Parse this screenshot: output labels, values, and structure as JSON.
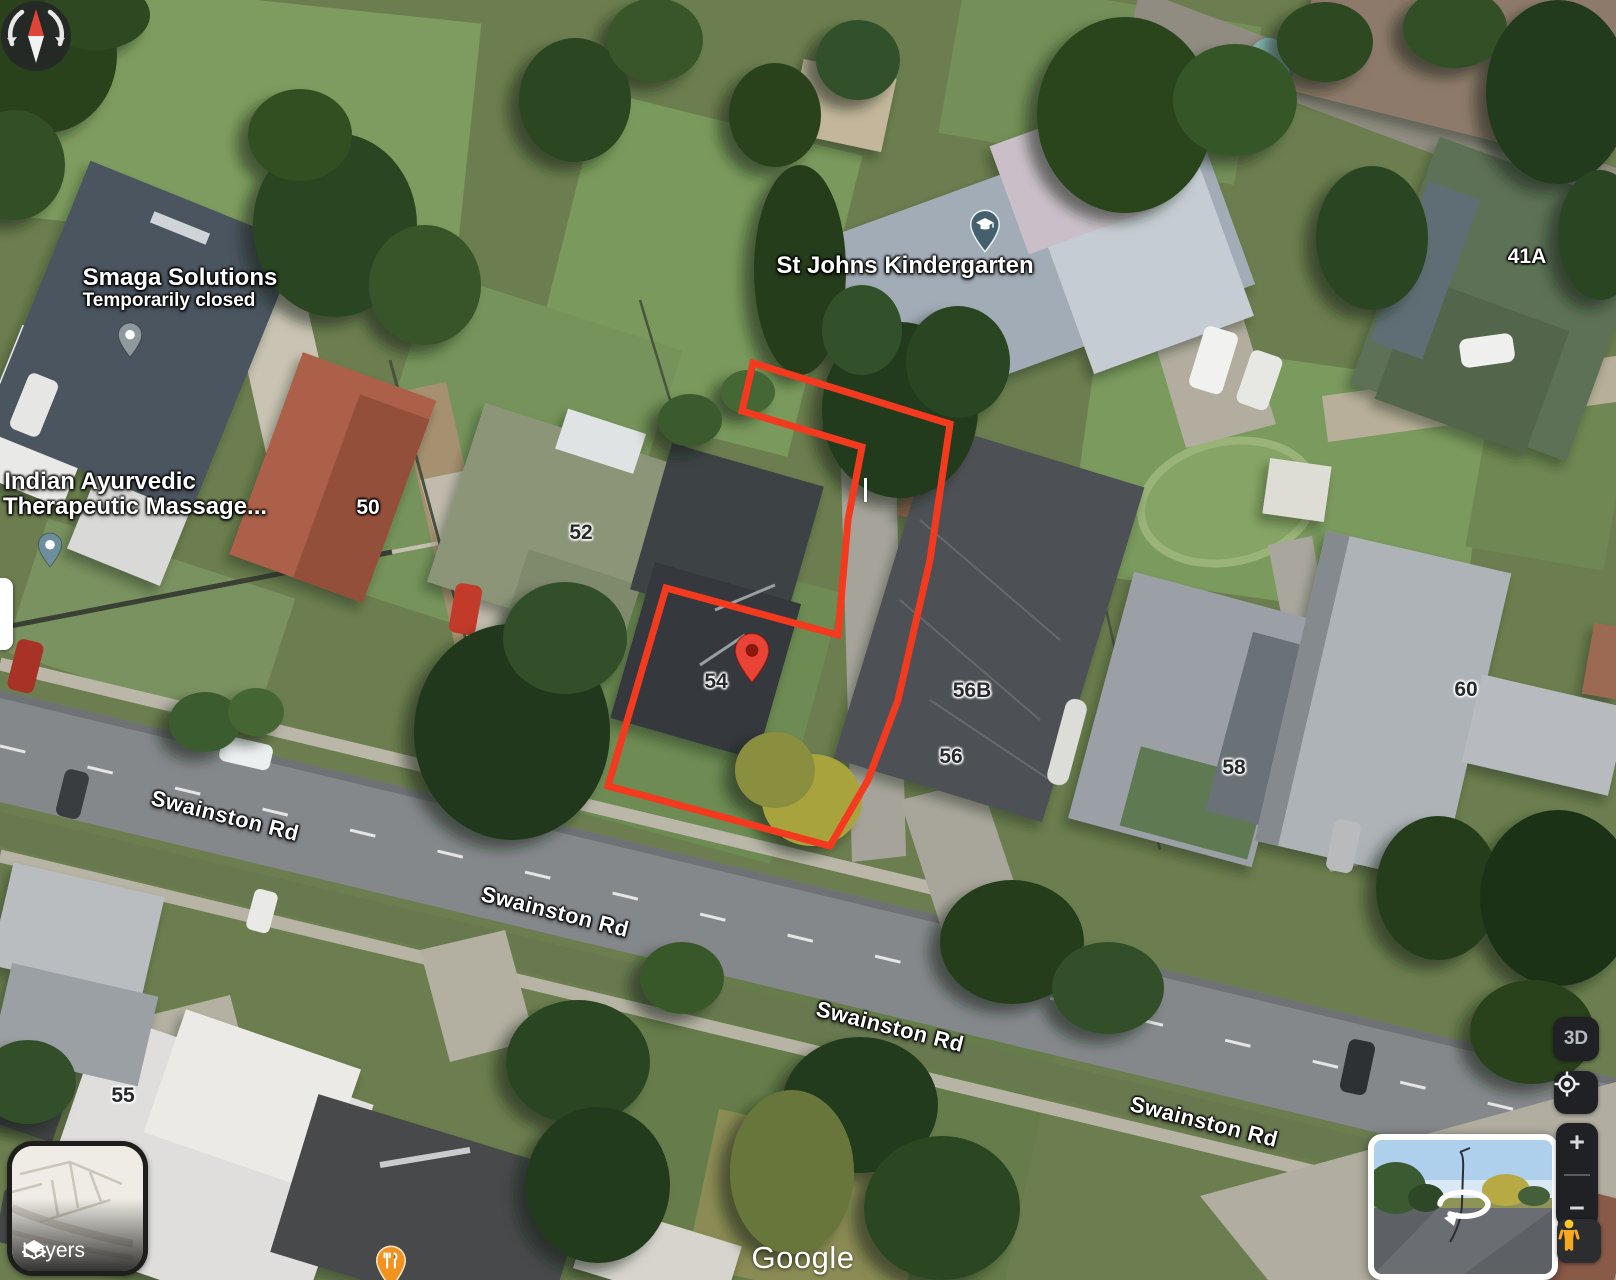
{
  "map": {
    "attribution": "Google",
    "street_label": "Swainston Rd",
    "street_label_partial": "S",
    "pois": {
      "smaga": {
        "name": "Smaga Solutions",
        "status": "Temporarily closed",
        "icon": "gray-place-pin"
      },
      "ayurvedic": {
        "name_line1": "Indian Ayurvedic",
        "name_line2": "Therapeutic Massage...",
        "icon": "teal-place-pin"
      },
      "kindergarten": {
        "name": "St Johns Kindergarten",
        "icon": "education-pin"
      },
      "restaurant": {
        "icon": "dining-pin"
      },
      "destination": {
        "icon": "red-map-pin"
      }
    },
    "house_numbers": {
      "h50": "50",
      "h52": "52",
      "h54": "54",
      "h55": "55",
      "h56": "56",
      "h56b": "56B",
      "h58": "58",
      "h60": "60",
      "h41a": "41A"
    }
  },
  "controls": {
    "layers": {
      "label": "Layers",
      "icon": "layers-diamond-icon"
    },
    "compass": {
      "icon": "compass-icon"
    },
    "three_d": {
      "label": "3D"
    },
    "my_location": {
      "icon": "crosshair-icon"
    },
    "zoom_in": "+",
    "zoom_out": "−",
    "pegman": {
      "icon": "pegman-icon"
    },
    "street_view": {
      "icon": "rotate-view-icon"
    }
  },
  "colors": {
    "boundary": "#f43a1e",
    "destination_pin": "#e94335",
    "destination_pin_core": "#8a180e",
    "dining_pin": "#f09321",
    "education_pin": "#44606c",
    "smaga_pin": "#8e999e",
    "ayurvedic_pin": "#6d8e9c",
    "control_bg": "#1f2124",
    "control_fg": "#d7d9da"
  }
}
